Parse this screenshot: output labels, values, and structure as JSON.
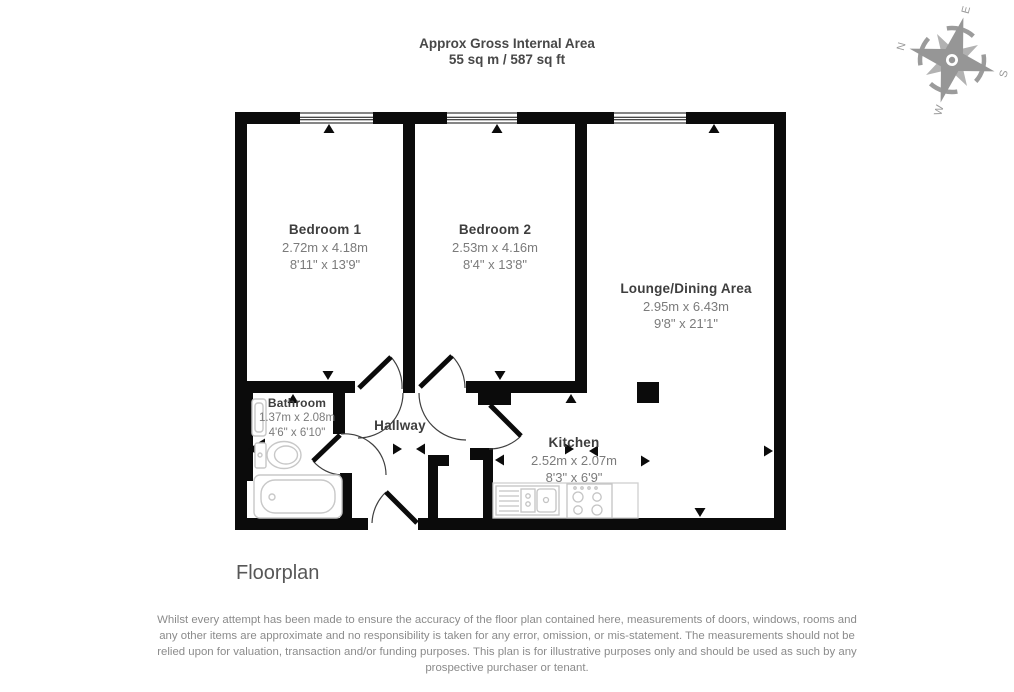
{
  "title": {
    "line1": "Approx Gross Internal Area",
    "line2": "55 sq m / 587 sq ft"
  },
  "compass": {
    "n": "N",
    "e": "E",
    "s": "S",
    "w": "W"
  },
  "rooms": {
    "bedroom1": {
      "name": "Bedroom 1",
      "metric": "2.72m x 4.18m",
      "imperial": "8'11\" x 13'9\""
    },
    "bedroom2": {
      "name": "Bedroom 2",
      "metric": "2.53m x 4.16m",
      "imperial": "8'4\" x 13'8\""
    },
    "lounge": {
      "name": "Lounge/Dining Area",
      "metric": "2.95m x 6.43m",
      "imperial": "9'8\" x 21'1\""
    },
    "bathroom": {
      "name": "Bathroom",
      "metric": "1.37m x 2.08m",
      "imperial": "4'6\" x 6'10\""
    },
    "hallway": {
      "name": "Hallway"
    },
    "kitchen": {
      "name": "Kitchen",
      "metric": "2.52m x 2.07m",
      "imperial": "8'3\" x 6'9\""
    }
  },
  "footer": {
    "caption": "Floorplan",
    "disclaimer_lines": [
      "Whilst every attempt has been made to ensure the accuracy of the floor plan contained here, measurements of doors, windows, rooms and",
      "any other items are approximate and no responsibility is taken for any error, omission, or mis-statement. The measurements should not be",
      "relied upon for valuation, transaction and/or funding purposes. This plan is for illustrative purposes only and should be used as such by any",
      "prospective purchaser or tenant."
    ]
  },
  "colors": {
    "wall": "#0b0b0b",
    "room_name_text": "#3e3e3e",
    "dimension_text": "#7b7b7b",
    "fixture_outline": "#c8c8c8",
    "compass_gray": "#999999"
  }
}
